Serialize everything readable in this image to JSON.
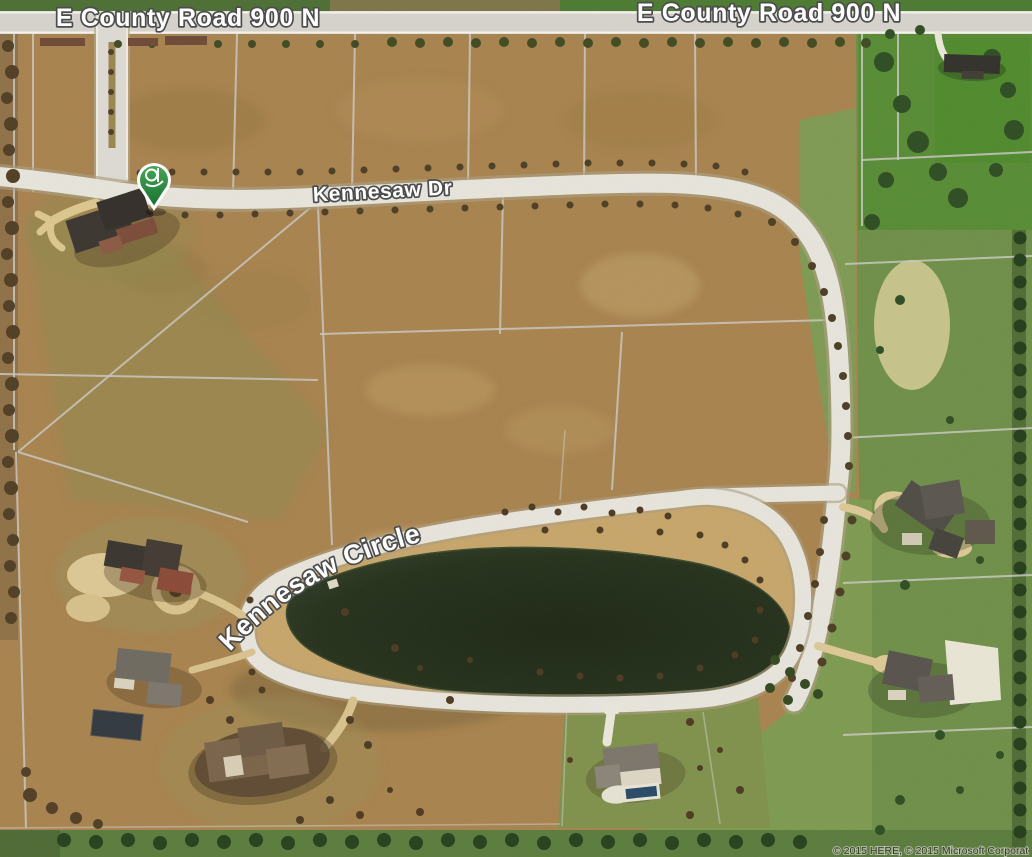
{
  "map": {
    "road_labels": {
      "county_road_left": "E County Road 900 N",
      "county_road_right": "E County Road 900 N",
      "kennesaw_dr": "Kennesaw Dr",
      "kennesaw_circle": "Kennesaw Circle"
    },
    "attribution": "© 2015 HERE, © 2015 Microsoft Corporat",
    "pin": {
      "type": "green-shield-pin"
    },
    "colors": {
      "field_brown": "#a8834e",
      "grass_green": "#6f8f48",
      "road_surface": "#e6e4db",
      "pond_dark": "#232e19",
      "label_fill": "#ffffff",
      "label_halo": "#4c4c4c",
      "pin_green": "#2a8a3c"
    }
  }
}
